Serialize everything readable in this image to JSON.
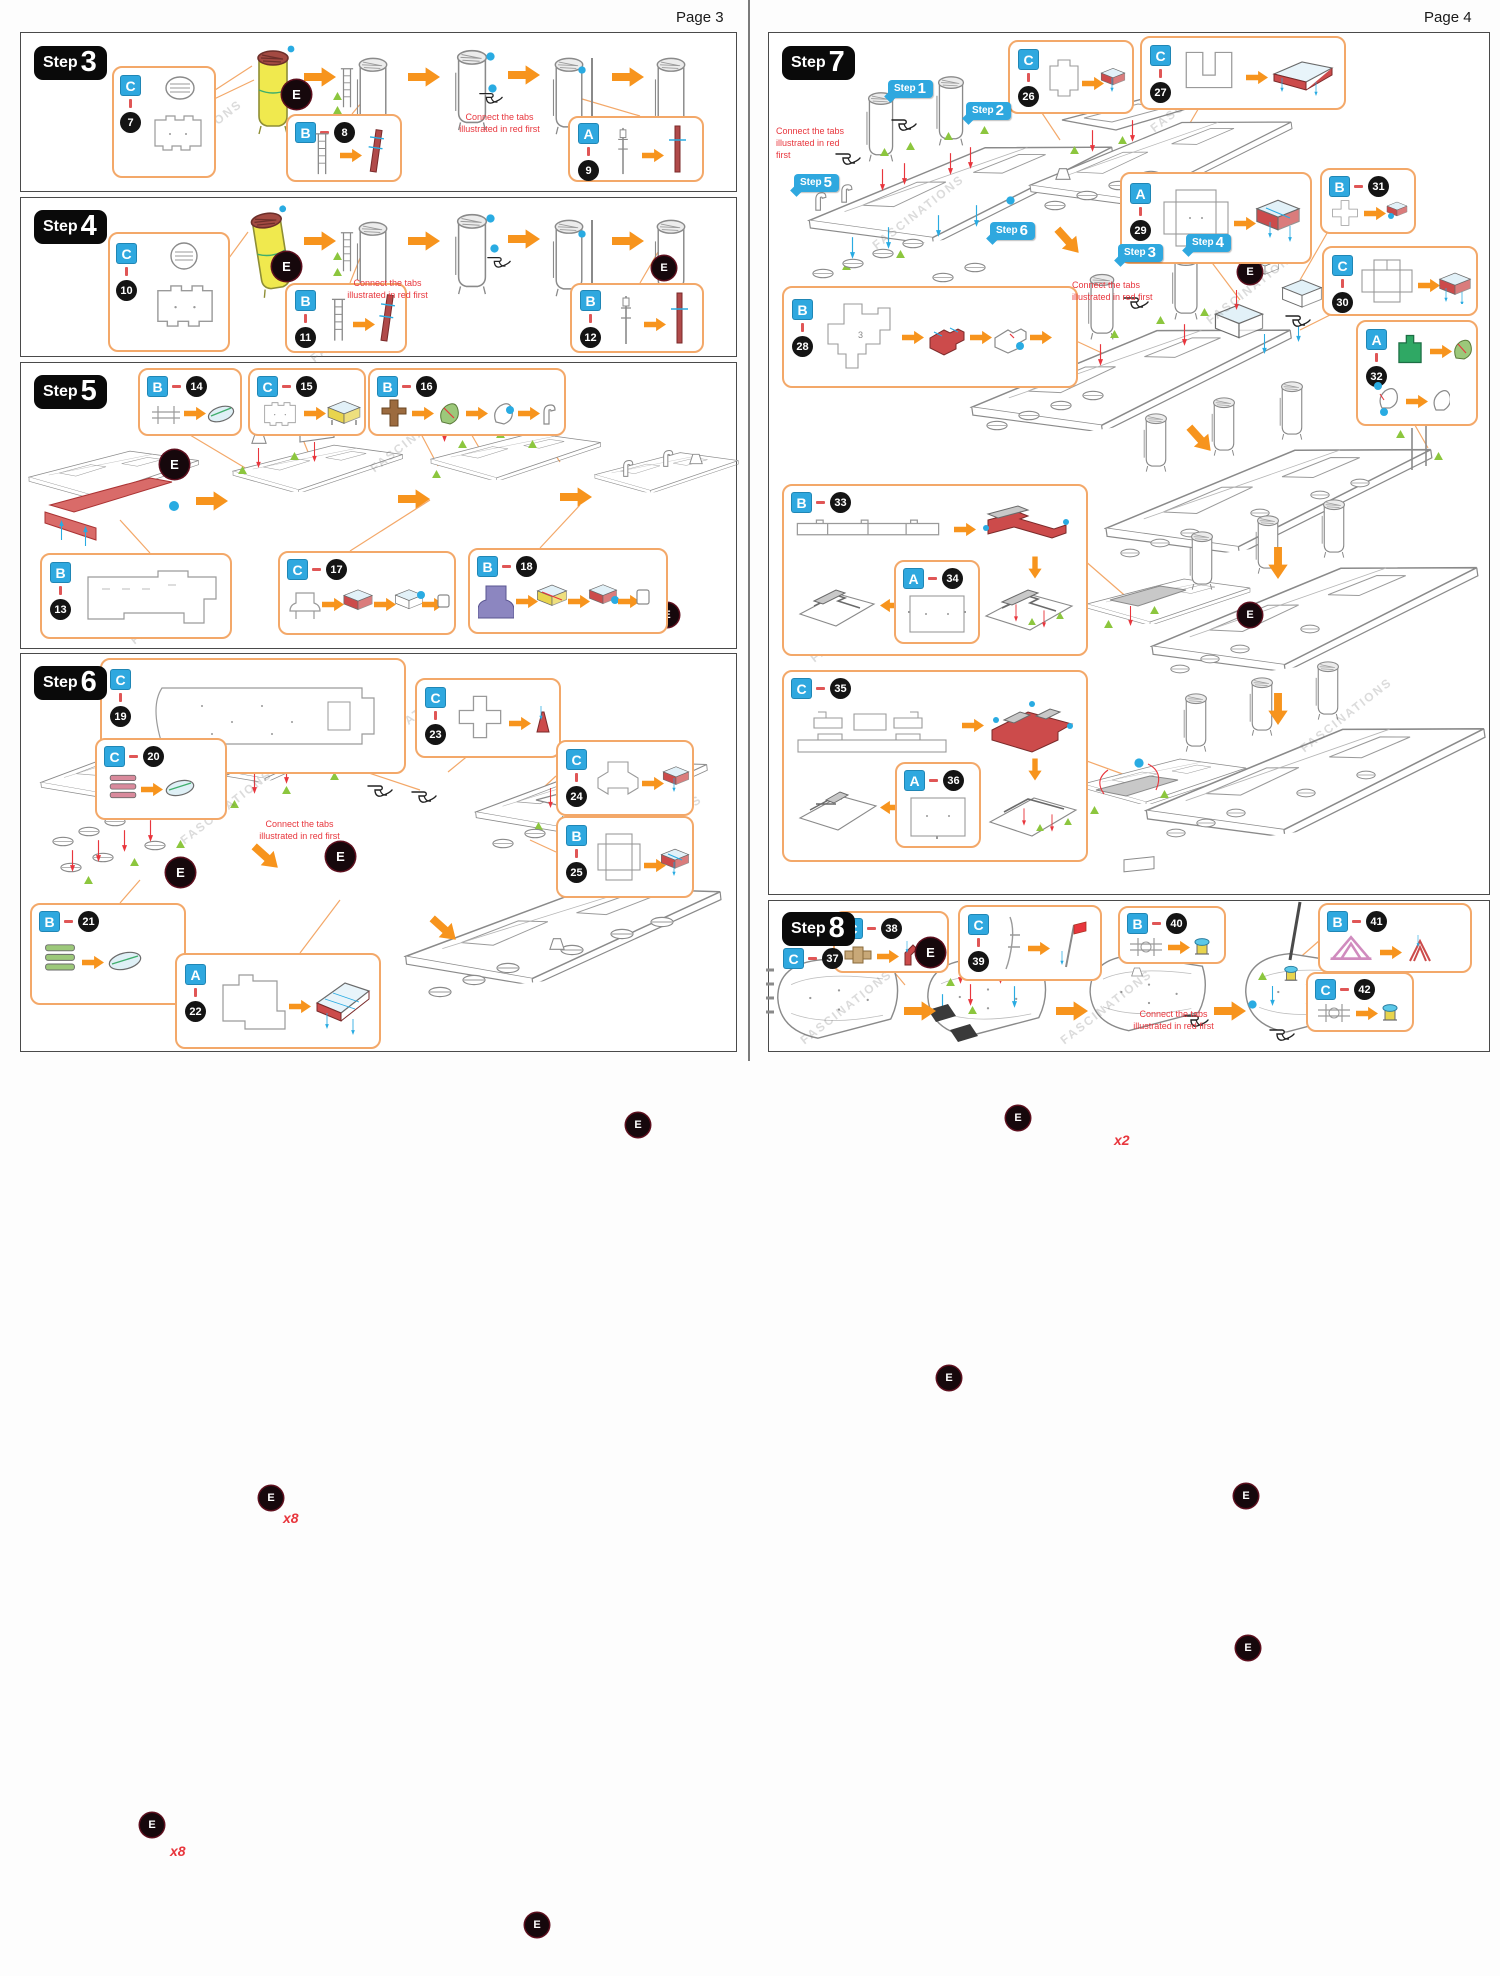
{
  "pages": {
    "p3": "Page 3",
    "p4": "Page 4"
  },
  "steps": {
    "s3": {
      "word": "Step",
      "num": "3"
    },
    "s4": {
      "word": "Step",
      "num": "4"
    },
    "s5": {
      "word": "Step",
      "num": "5"
    },
    "s6": {
      "word": "Step",
      "num": "6"
    },
    "s7": {
      "word": "Step",
      "num": "7"
    },
    "s8": {
      "word": "Step",
      "num": "8"
    }
  },
  "tags": {
    "t1": {
      "word": "Step",
      "num": "1"
    },
    "t2": {
      "word": "Step",
      "num": "2"
    },
    "t3": {
      "word": "Step",
      "num": "3"
    },
    "t4": {
      "word": "Step",
      "num": "4"
    },
    "t5": {
      "word": "Step",
      "num": "5"
    },
    "t6": {
      "word": "Step",
      "num": "6"
    }
  },
  "labels": {
    "e": "E",
    "x2": "x2",
    "x3": "x3",
    "x5": "x5",
    "x8": "x8",
    "watermark": "FASCINATIONS"
  },
  "notes": {
    "connect": "Connect the tabs illustrated in red first"
  },
  "callouts": {
    "c7": {
      "letter": "C",
      "number": "7"
    },
    "b8": {
      "letter": "B",
      "number": "8"
    },
    "a9": {
      "letter": "A",
      "number": "9"
    },
    "c10": {
      "letter": "C",
      "number": "10"
    },
    "b11": {
      "letter": "B",
      "number": "11"
    },
    "b12": {
      "letter": "B",
      "number": "12"
    },
    "b13": {
      "letter": "B",
      "number": "13"
    },
    "b14": {
      "letter": "B",
      "number": "14"
    },
    "c15": {
      "letter": "C",
      "number": "15"
    },
    "b16": {
      "letter": "B",
      "number": "16",
      "mult": "x3"
    },
    "c17": {
      "letter": "C",
      "number": "17"
    },
    "b18": {
      "letter": "B",
      "number": "18",
      "mult": "x2"
    },
    "c19": {
      "letter": "C",
      "number": "19"
    },
    "c20": {
      "letter": "C",
      "number": "20",
      "mult": "x8"
    },
    "b21": {
      "letter": "B",
      "number": "21",
      "mult": "x8"
    },
    "a22": {
      "letter": "A",
      "number": "22"
    },
    "c23": {
      "letter": "C",
      "number": "23"
    },
    "c24": {
      "letter": "C",
      "number": "24"
    },
    "b25": {
      "letter": "B",
      "number": "25"
    },
    "c26": {
      "letter": "C",
      "number": "26"
    },
    "c27": {
      "letter": "C",
      "number": "27"
    },
    "b28": {
      "letter": "B",
      "number": "28"
    },
    "a29": {
      "letter": "A",
      "number": "29"
    },
    "c30": {
      "letter": "C",
      "number": "30"
    },
    "b31": {
      "letter": "B",
      "number": "31"
    },
    "a32": {
      "letter": "A",
      "number": "32",
      "mult": "x2"
    },
    "b33": {
      "letter": "B",
      "number": "33"
    },
    "a34": {
      "letter": "A",
      "number": "34"
    },
    "c35": {
      "letter": "C",
      "number": "35"
    },
    "a36": {
      "letter": "A",
      "number": "36"
    },
    "c37": {
      "letter": "C",
      "number": "37"
    },
    "c38": {
      "letter": "C",
      "number": "38",
      "mult": "x5"
    },
    "c39": {
      "letter": "C",
      "number": "39"
    },
    "b40": {
      "letter": "B",
      "number": "40"
    },
    "b41": {
      "letter": "B",
      "number": "41",
      "mult": "x2"
    },
    "c42": {
      "letter": "C",
      "number": "42"
    }
  },
  "colors": {
    "accent_orange": "#F7941D",
    "callout_border": "#F3A869",
    "badge_blue": "#2FA8DF",
    "marker_red": "#E8363D",
    "marker_green": "#8CC63E",
    "marker_cyan": "#29ABE2",
    "part_yellow": "#F0E94E",
    "part_red": "#CC4B4B"
  }
}
